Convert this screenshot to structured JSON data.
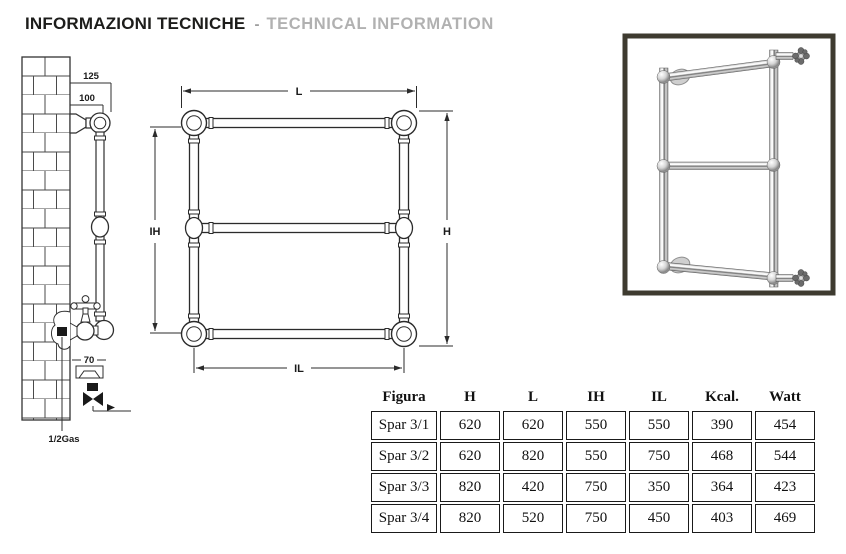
{
  "title": {
    "primary": "INFORMAZIONI TECNICHE",
    "separator": "-",
    "secondary": "TECHNICAL INFORMATION"
  },
  "diagram": {
    "side_view": {
      "dim_wall_to_outer": "125",
      "dim_wall_to_inner": "100",
      "dim_bracket": "70",
      "connection_label": "1/2Gas"
    },
    "front_view": {
      "dim_length": "L",
      "dim_height": "H",
      "dim_inner_height": "IH",
      "dim_inner_length": "IL"
    }
  },
  "table": {
    "headers": [
      "Figura",
      "H",
      "L",
      "IH",
      "IL",
      "Kcal.",
      "Watt"
    ],
    "rows": [
      [
        "Spar 3/1",
        "620",
        "620",
        "550",
        "550",
        "390",
        "454"
      ],
      [
        "Spar 3/2",
        "620",
        "820",
        "550",
        "750",
        "468",
        "544"
      ],
      [
        "Spar 3/3",
        "820",
        "420",
        "750",
        "350",
        "364",
        "423"
      ],
      [
        "Spar 3/4",
        "820",
        "520",
        "750",
        "450",
        "403",
        "469"
      ]
    ]
  },
  "colors": {
    "title_primary": "#1d1d1b",
    "title_secondary": "#b1b1b1",
    "drawing_line": "#2f2f2f",
    "photo_frame_border": "#3e3b30",
    "table_border": "#1a1a1a"
  }
}
